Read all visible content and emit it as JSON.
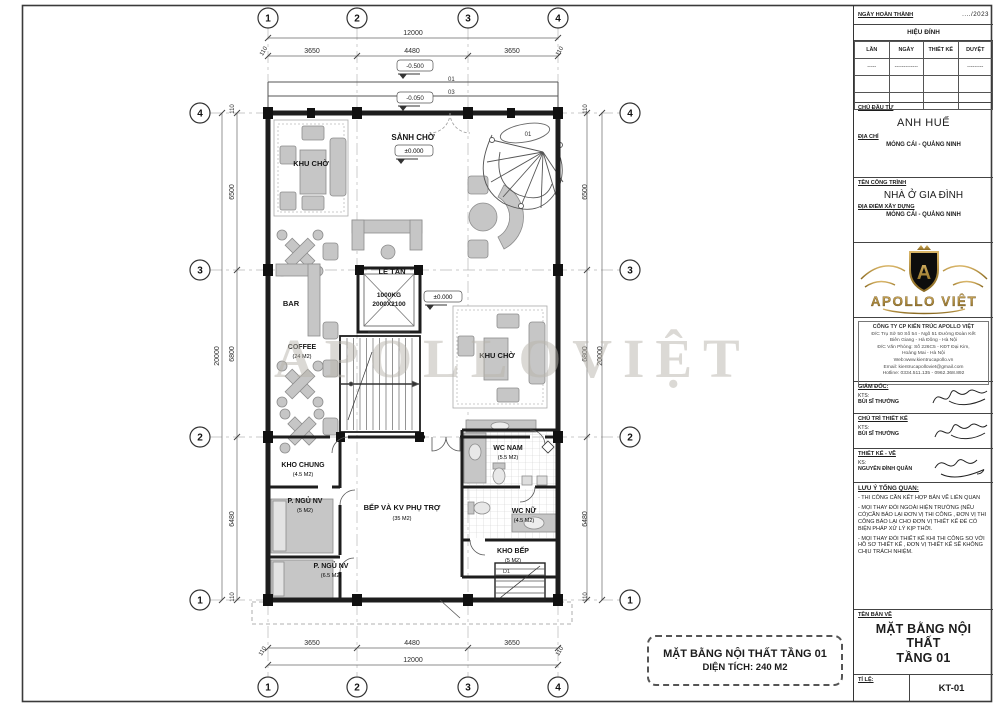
{
  "colors": {
    "accent_gold": "#a8842e",
    "line": "#1d1d1d",
    "furniture": "#c6c6c6",
    "watermark": "#b9b5ac"
  },
  "plan": {
    "watermark": "APOLLOVIỆT",
    "caption1": "MẶT BẰNG NỘI THẤT TẦNG 01",
    "caption2": "DIỆN TÍCH: 240 M2",
    "grid": {
      "cols": [
        "1",
        "2",
        "3",
        "4"
      ],
      "rows": [
        "4",
        "3",
        "2",
        "1"
      ]
    },
    "dims": {
      "h_total": "12000",
      "h": [
        "110",
        "3650",
        "4480",
        "3650",
        "110"
      ],
      "v_total": "20000",
      "v": [
        "110",
        "6500",
        "6800",
        "6480",
        "110"
      ]
    },
    "levels": {
      "porch": "-0.500",
      "tag01": "01",
      "step": "-0.050",
      "tag03": "03",
      "zero": "±0.000"
    },
    "rooms": {
      "khu_cho": "KHU CHỜ",
      "sanh_cho": "SẢNH CHỜ",
      "le_tan": "LỄ TÂN",
      "bar": "BAR",
      "coffee": "COFFEE",
      "coffee_area": "(24 M2)",
      "lift1": "1000KG",
      "lift2": "2000X2100",
      "khu_cho2": "KHU CHỜ",
      "kho_chung": "KHO CHUNG",
      "kho_chung_area": "(4.5 M2)",
      "ngu1": "P. NGỦ NV",
      "ngu1_area": "(5 M2)",
      "ngu2": "P. NGỦ NV",
      "ngu2_area": "(6.5 M2)",
      "bep": "BẾP VÀ KV PHỤ TRỢ",
      "bep_area": "(35 M2)",
      "wc_nam": "WC NAM",
      "wc_nam_area": "(5.5 M2)",
      "wc_nu": "WC NỮ",
      "wc_nu_area": "(4.5 M2)",
      "kho_bep": "KHO BẾP",
      "kho_bep_area": "(5 M2)",
      "stair_tag": "01",
      "door_tag": "D1"
    }
  },
  "tb": {
    "date_label": "NGÀY HOÀN THÀNH",
    "date_value": "..../2023",
    "rev": {
      "title": "HIỆU ĐÍNH",
      "cols": [
        "LẦN",
        "NGÀY",
        "THIẾT KẾ",
        "DUYỆT"
      ],
      "row": [
        "-----",
        "-------------",
        "",
        "---------"
      ]
    },
    "owner": {
      "label": "CHỦ ĐẦU TƯ",
      "name": "ANH HUẾ",
      "addr_label": "ĐỊA CHỈ",
      "addr": "MÓNG CÁI - QUẢNG NINH"
    },
    "project": {
      "label": "TÊN CÔNG TRÌNH",
      "name": "NHÀ Ở GIA ĐÌNH",
      "site_label": "ĐỊA ĐIỂM XÂY DỰNG",
      "site": "MÓNG CÁI - QUẢNG NINH"
    },
    "logo": {
      "monogram": "A",
      "brand": "APOLLO VIỆT"
    },
    "company": {
      "name": "CÔNG TY CP KIẾN TRÚC APOLLO VIỆT",
      "lines": [
        "Đ/C Trụ Sở 50 Số 54 - Ngõ 51 Đường Đoàn Kết",
        "Biên Giang - Hà Đông - Hà Nội",
        "Đ/C Văn Phòng: Số 226C5 - KĐT Đại Kim,",
        "Hoàng Mai - Hà Nội",
        "Web:www.kientrucapollo.vn",
        "Email: kientrucapolloviet@gmail.com",
        "Hotline: 0334.511.135 - 0962.368.892"
      ]
    },
    "sign": [
      {
        "role": "GIÁM ĐỐC:",
        "title": "KTS:",
        "name": "BÙI SĨ THƯỞNG"
      },
      {
        "role": "CHỦ TRÌ THIẾT KẾ",
        "title": "KTS:",
        "name": "BÙI SĨ THƯỞNG"
      },
      {
        "role": "THIẾT KẾ - VẼ",
        "title": "KS:",
        "name": "NGUYỄN ĐÌNH QUÂN"
      }
    ],
    "notes": {
      "title": "LƯU Ý TỔNG QUAN:",
      "items": [
        "- THI CÔNG CẦN KẾT HỢP BẢN VẼ LIÊN QUAN",
        "- MỌI THAY ĐỔI NGOÀI HIỆN TRƯỜNG (NẾU CÓ)CẦN BÁO LẠI ĐƠN VỊ THI CÔNG , ĐƠN VỊ THI CÔNG BÁO LẠI CHO ĐƠN VỊ THIẾT KẾ ĐỂ CÓ BIỆN PHÁP XỬ LÝ KỊP THỜI.",
        "- MỌI THAY ĐỔI THIẾT KẾ KHI THI CÔNG SO VỚI HỒ SƠ THIẾT KẾ , ĐƠN VỊ THIẾT KẾ SẼ KHÔNG CHỊU TRÁCH NHIỆM."
      ]
    },
    "drawing": {
      "label": "TÊN BẢN VẼ",
      "line1": "MẶT BẰNG NỘI THẤT",
      "line2": "TẦNG 01",
      "scale_label": "TỈ LỆ:",
      "number": "KT-01"
    }
  }
}
